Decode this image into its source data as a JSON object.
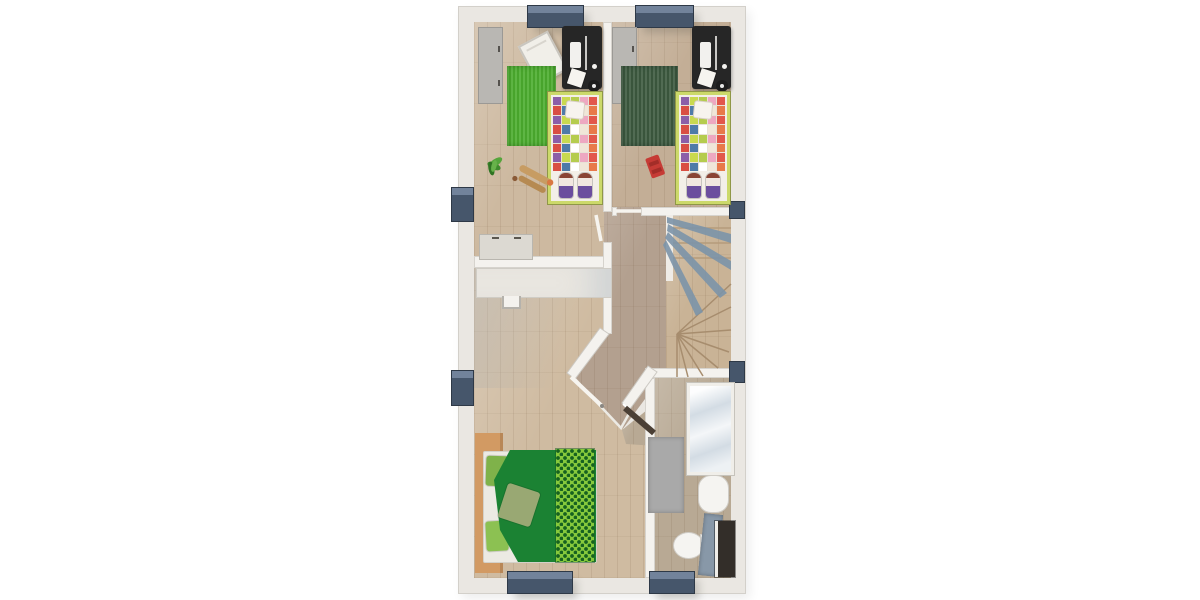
{
  "meta": {
    "type": "floor-plan",
    "view": "top-down-3d-render",
    "description": "Upper-storey floor plan: two children's bedrooms at top, landing with winder staircase, master bedroom bottom-left, bathroom bottom-right",
    "visible_text": ""
  },
  "palette": {
    "page_bg": "#ffffff",
    "wall_outer": "#eae7e2",
    "wall_inner": "#f4f2ee",
    "floor_kids_left": "#cdb9a0",
    "floor_kids_right": "#c3ae96",
    "floor_hall": "#b3a08f",
    "floor_master": "#cfbba1",
    "floor_bath": "#b8a994",
    "floor_stairs": "#c9b396",
    "window": "#46566b",
    "window_light": "#72839b",
    "rug_bright_green": "#4cae2f",
    "rug_dark_green": "#3d5a40",
    "wardrobe_gray": "#b9b7b3",
    "desk_black": "#262626",
    "kids_bed_frame": "#ccd96a",
    "duvet_green": "#1b8233",
    "throw_lime": "#86c93c",
    "pillow_green_a": "#7fb24a",
    "pillow_green_b": "#8cc152",
    "pillow_sage": "#99a873",
    "bed_wood": "#d29a63",
    "shower_glass": "#d3dce4",
    "bath_mat": "#a9a9a9",
    "fixture_white": "#f5f4f1",
    "cabinet_dark": "#332e29",
    "laundry_blue_gray": "#8898a8",
    "toy_car_red": "#c63b35",
    "door_dark": "#4a3f35",
    "railing_slate": "#7b94a9"
  },
  "rooms": [
    {
      "id": "kids-bedroom-left",
      "furniture": [
        "wardrobe",
        "drawing-board",
        "desk-with-computer",
        "desk-stool",
        "green-rug",
        "single-bed-patchwork",
        "bed-dolls",
        "potted-plant",
        "wooden-toy",
        "white-dresser"
      ]
    },
    {
      "id": "kids-bedroom-right",
      "furniture": [
        "wardrobe",
        "desk-with-computer",
        "desk-stool",
        "dark-green-rug",
        "single-bed-patchwork",
        "bed-dolls",
        "red-toy-car"
      ]
    },
    {
      "id": "landing",
      "furniture": [
        "winder-staircase",
        "stair-railing"
      ]
    },
    {
      "id": "master-bedroom",
      "furniture": [
        "built-in-closet",
        "closet-handle",
        "wood-bed-frame",
        "double-bed",
        "green-duvet",
        "lime-throw",
        "pillows"
      ]
    },
    {
      "id": "bathroom",
      "furniture": [
        "shower",
        "bath-mat",
        "washbasin",
        "toilet",
        "laundry-basket",
        "dark-cabinet"
      ]
    }
  ],
  "kids_bed": {
    "quilt_palette": [
      "#c9d94f",
      "#e2574c",
      "#ffffff",
      "#8b5fa8",
      "#eda8c1",
      "#4f7ba8",
      "#e8794a",
      "#b5cc4e",
      "#d94f43",
      "#f0e6d8"
    ],
    "quilt_rows": 8,
    "quilt_cols": 5
  },
  "windows": {
    "count": 8,
    "color": "#46566b"
  },
  "stairs": {
    "railing_color": "#7b94a9",
    "tread_color": "#a78d6e"
  }
}
